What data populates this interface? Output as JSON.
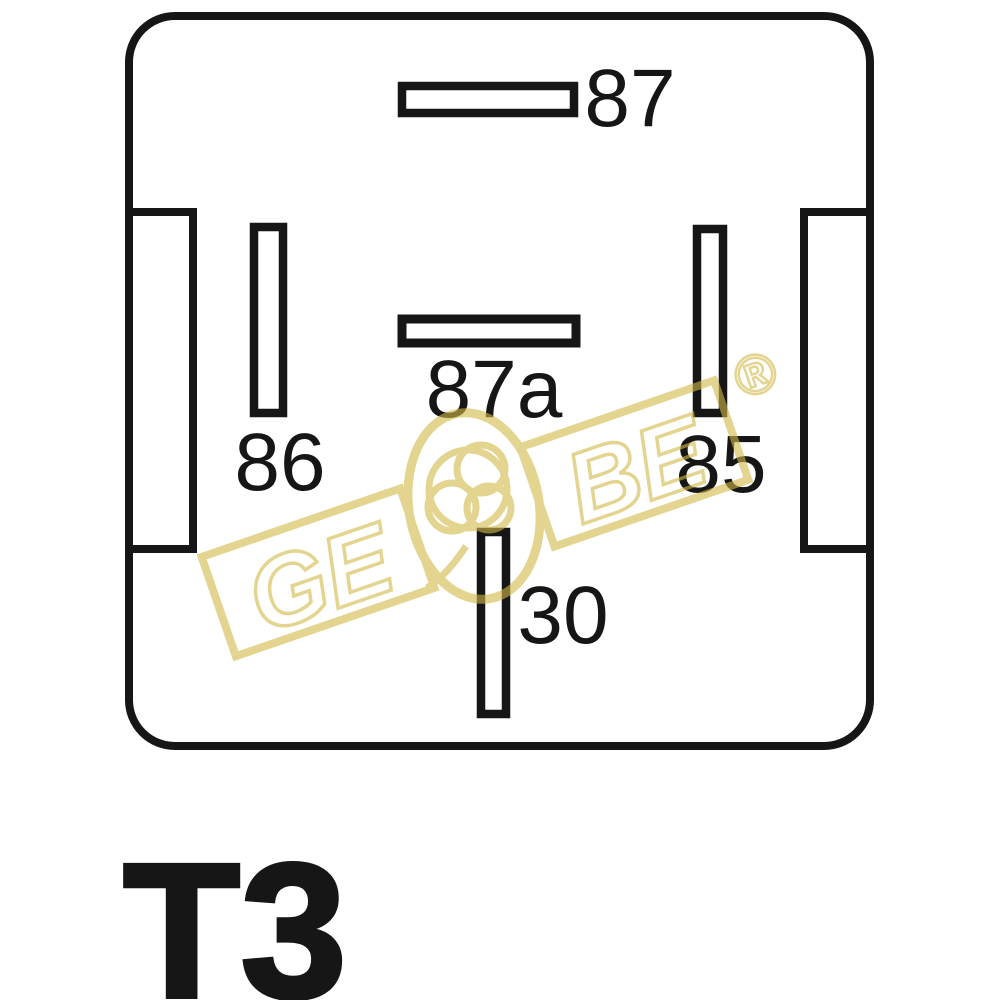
{
  "diagram": {
    "title_hint": "automotive relay terminal pinout",
    "pins": {
      "top": "87",
      "middle": "87a",
      "left": "86",
      "right": "85",
      "bottom": "30"
    },
    "type_label": "T3"
  },
  "watermark": {
    "left_text": "GE",
    "right_text": "BE",
    "registered_mark": "®"
  },
  "colors": {
    "line": "#161616",
    "wm": "#d2b948",
    "bg": "#ffffff",
    "text": "#161616"
  }
}
